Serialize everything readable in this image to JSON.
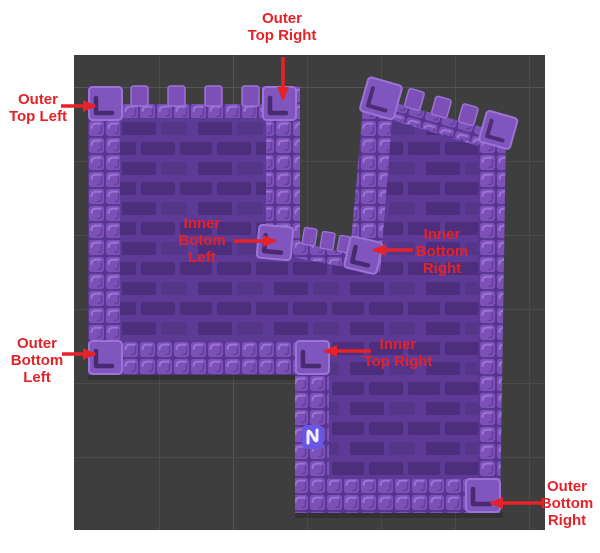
{
  "scene_view": {
    "background_color": "#3e3e3e",
    "grid_color": "#4b4b4c"
  },
  "annotation": {
    "color": "#e52228"
  },
  "labels": {
    "outer_top_left": {
      "lines": [
        "Outer",
        "Top Left"
      ]
    },
    "outer_top_right": {
      "lines": [
        "Outer",
        "Top Right"
      ]
    },
    "inner_botom_left": {
      "lines": [
        "Inner",
        "Botom",
        "Left"
      ]
    },
    "inner_bottom_right": {
      "lines": [
        "Inner",
        "Bottom",
        "Right"
      ]
    },
    "outer_bottom_left": {
      "lines": [
        "Outer",
        "Bottom",
        "Left"
      ]
    },
    "inner_top_right": {
      "lines": [
        "Inner",
        "Top Right"
      ]
    },
    "outer_bottom_right": {
      "lines": [
        "Outer",
        "Bottom",
        "Right"
      ]
    }
  },
  "tilemap": {
    "wall_color": "#7c50b7",
    "wall_highlight": "#9c73d7",
    "wall_gap_color": "#563490",
    "interior_color": "#5c3a96",
    "brick_color": "#4d2e7c",
    "corner_shadow": "#3e2363",
    "wave_icon_color": "#6857e5"
  }
}
